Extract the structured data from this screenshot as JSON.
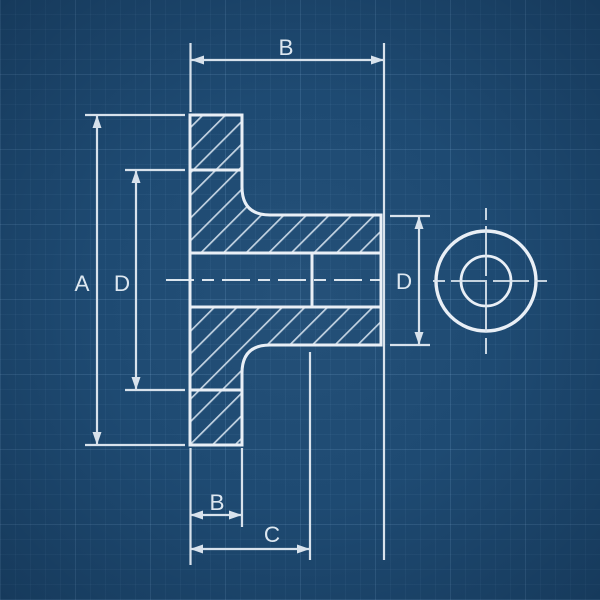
{
  "labels": {
    "dim_b_top": "B",
    "dim_a": "A",
    "dim_d_left": "D",
    "dim_d_right": "D",
    "dim_b_bottom": "B",
    "dim_c": "C"
  },
  "colors": {
    "paper_background": "#1e4a72",
    "object_line": "#e9eff6",
    "dimension_line": "#d8e2ec",
    "hatch_line": "#c3d3e2",
    "label_text": "#dde7f0",
    "grid_line": "#96c3eb"
  }
}
